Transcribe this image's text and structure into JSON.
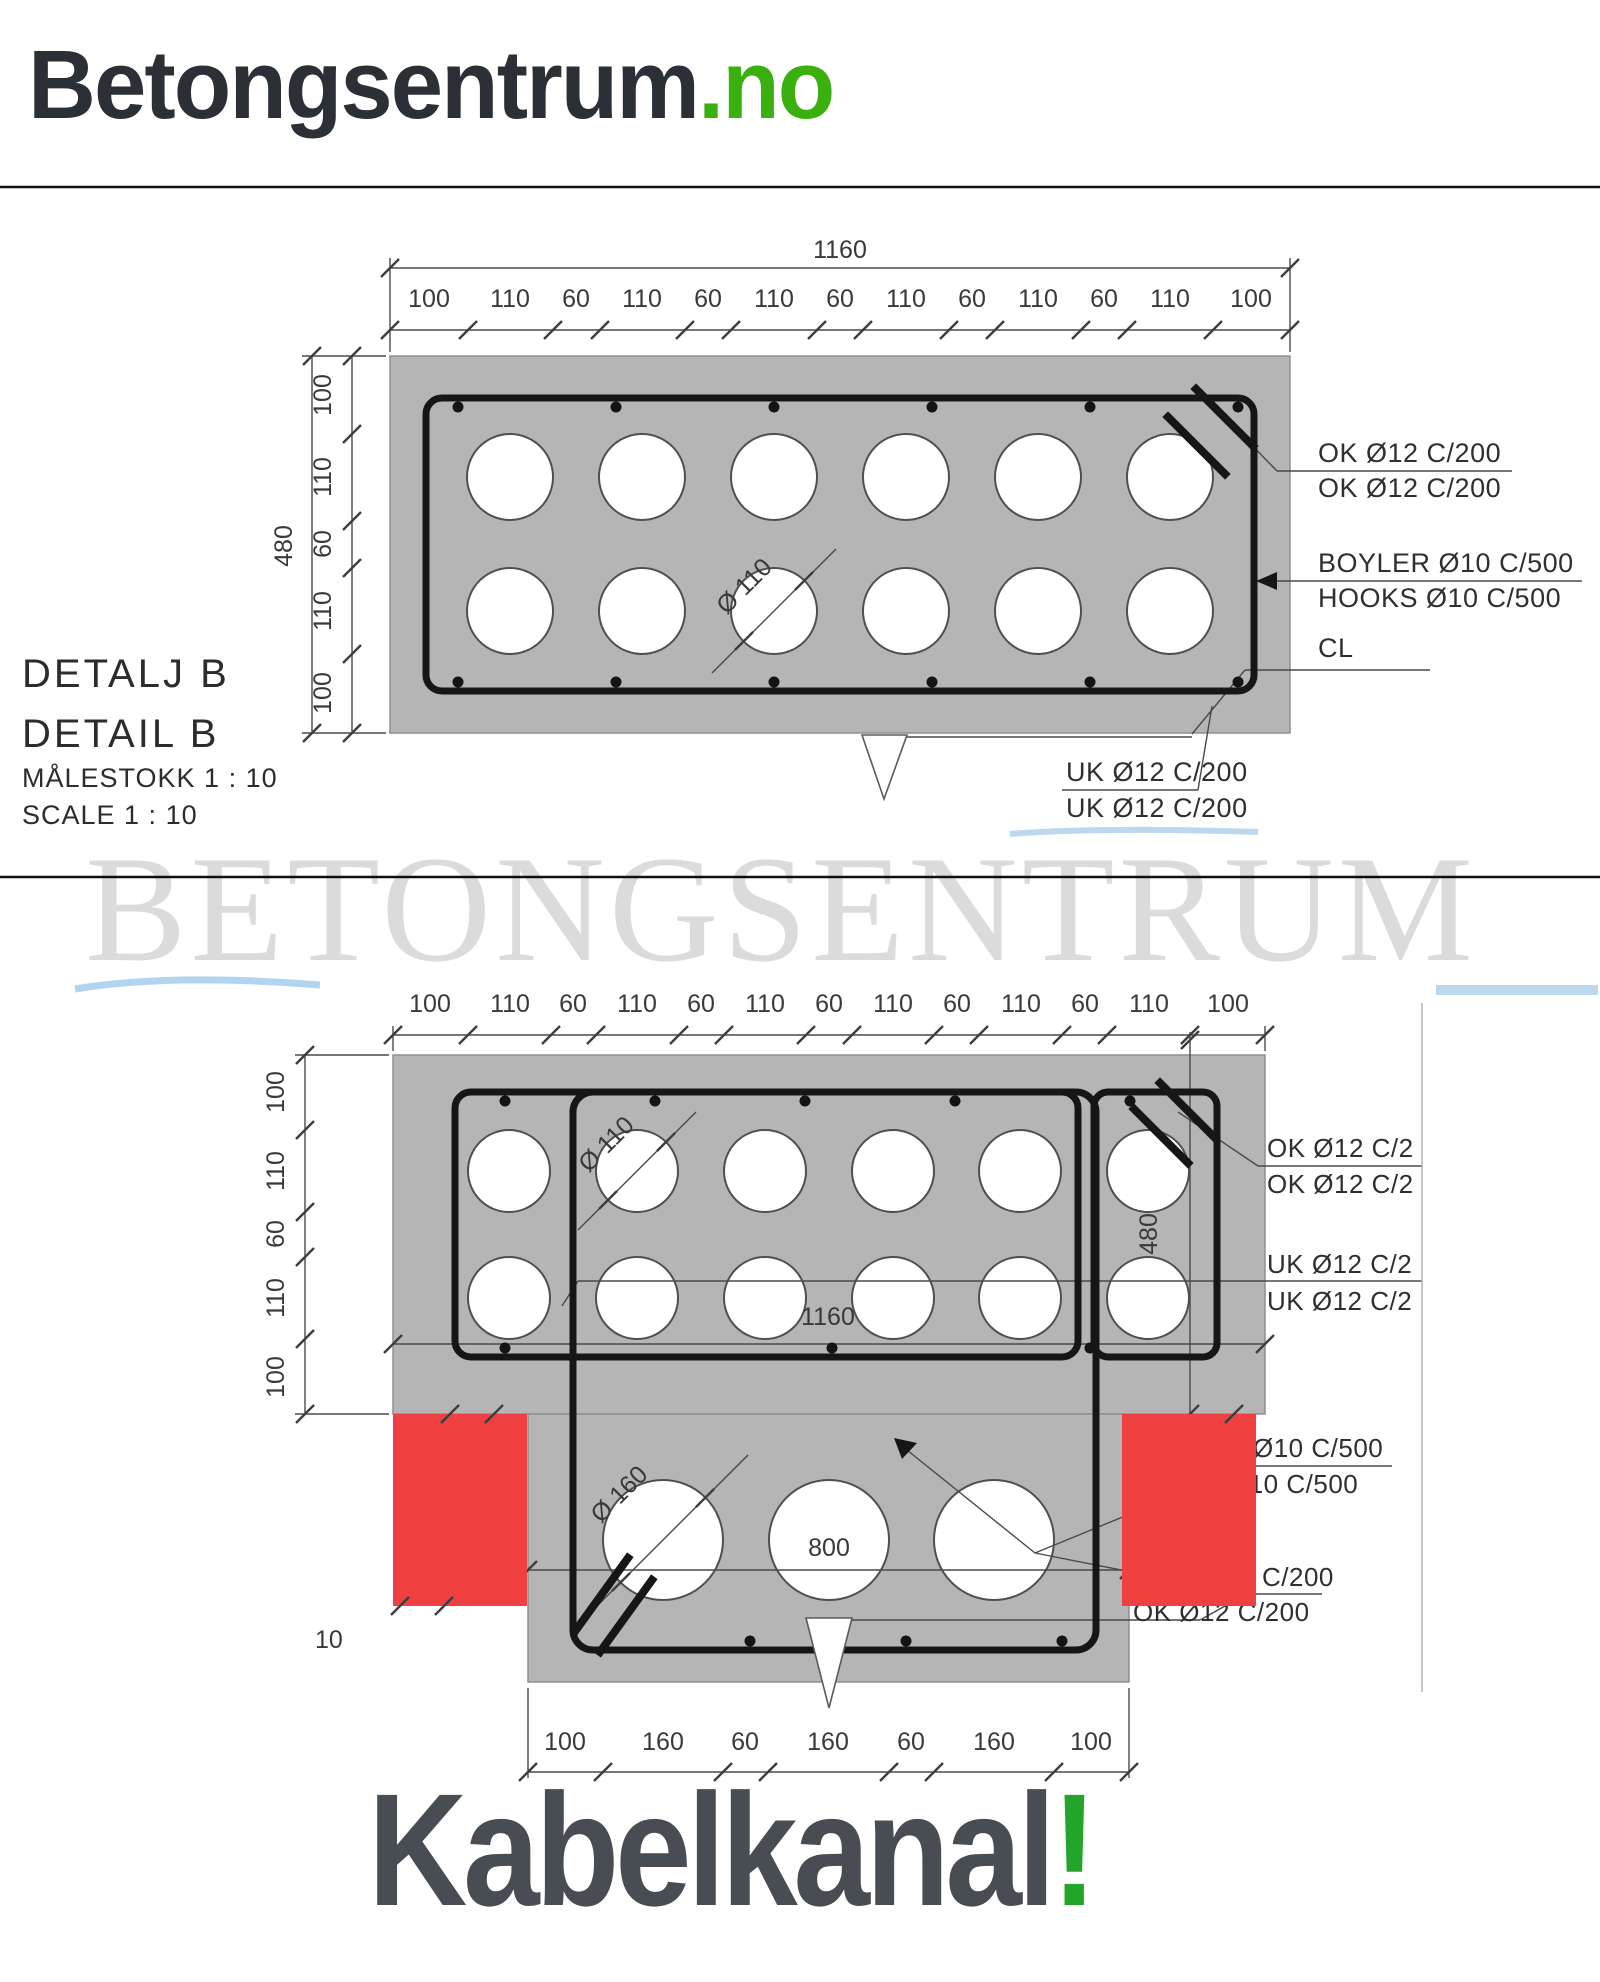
{
  "logo": {
    "brand": "Betongsentrum",
    "tld": ".no"
  },
  "watermark": "BETONGSENTRUM",
  "footer": {
    "title": "Kabelkanal",
    "bang": "!"
  },
  "colors": {
    "accent_green": "#3ab00f",
    "concrete_gray": "#b5b5b5",
    "rebar_black": "#161616",
    "highlight_red": "#ee4040",
    "watermark_gray": "#dbdbdb"
  },
  "drawing1": {
    "overall_width": "1160",
    "top_dims": [
      "100",
      "110",
      "60",
      "110",
      "60",
      "110",
      "60",
      "110",
      "60",
      "110",
      "60",
      "110",
      "100"
    ],
    "overall_height": "480",
    "left_dims": [
      "100",
      "110",
      "60",
      "110",
      "100"
    ],
    "hole_label": "Ø 110",
    "title_line1": "DETALJ B",
    "title_line2": "DETAIL B",
    "title_line3": "MÅLESTOKK  1 : 10",
    "title_line4": "SCALE  1 : 10",
    "ann_ok1": "OK Ø12 C/200",
    "ann_ok2": "OK Ø12 C/200",
    "ann_boyler": "BOYLER Ø10 C/500",
    "ann_hooks": "HOOKS Ø10 C/500",
    "ann_cl": "CL",
    "ann_uk1": "UK Ø12 C/200",
    "ann_uk2": "UK Ø12 C/200"
  },
  "drawing2": {
    "top_dims": [
      "100",
      "110",
      "60",
      "110",
      "60",
      "110",
      "60",
      "110",
      "60",
      "110",
      "60",
      "110",
      "100"
    ],
    "left_dims": [
      "100",
      "110",
      "60",
      "110",
      "100"
    ],
    "height_label": "480",
    "inner_width": "1160",
    "hole_label_small": "Ø 110",
    "hole_label_large": "Ø 160",
    "body_width": "800",
    "bottom_dims": [
      "100",
      "160",
      "60",
      "160",
      "60",
      "160",
      "100"
    ],
    "stray_label": "10",
    "ann_ok1": "OK Ø12 C/2",
    "ann_ok2": "OK Ø12 C/2",
    "ann_uk1": "UK Ø12 C/2",
    "ann_uk2": "UK Ø12 C/2",
    "ann_d10_1": "Ø10 C/500",
    "ann_d10_2": "Ø10 C/500",
    "ann_c200": "C/200",
    "ann_ok200": "OK Ø12 C/200"
  }
}
